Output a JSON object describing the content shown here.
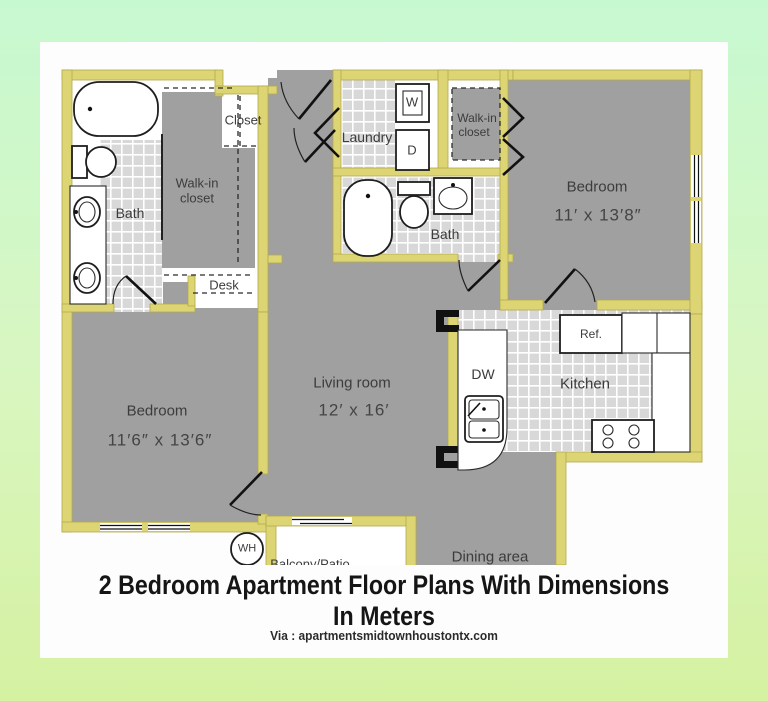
{
  "caption": {
    "title": "2 Bedroom Apartment Floor Plans With Dimensions In Meters",
    "credit": "Via : apartmentsmidtownhoustontx.com"
  },
  "plan": {
    "bedroom_left": {
      "name": "Bedroom",
      "dim": "11′6″ x 13′6″"
    },
    "bedroom_right": {
      "name": "Bedroom",
      "dim": "11′ x 13′8″"
    },
    "living_room": {
      "name": "Living room",
      "dim": "12′ x 16′"
    },
    "kitchen": {
      "name": "Kitchen"
    },
    "dining": {
      "name": "Dining area"
    },
    "bath_left": {
      "name": "Bath"
    },
    "bath_right": {
      "name": "Bath"
    },
    "laundry": {
      "name": "Laundry"
    },
    "walkin_left": {
      "line1": "Walk-in",
      "line2": "closet"
    },
    "walkin_right": {
      "line1": "Walk-in",
      "line2": "closet"
    },
    "closet": {
      "name": "Closet"
    },
    "desk": {
      "name": "Desk"
    },
    "balcony": {
      "name": "Balcony/Patio"
    },
    "washer": "W",
    "dryer": "D",
    "dishwasher": "DW",
    "refrigerator": "Ref.",
    "water_heater": "WH"
  },
  "colors": {
    "wall": "#ddd574",
    "room": "#a0a0a0",
    "tile": "#d8d8d8",
    "background_top": "#c7f9d1",
    "background_bottom": "#d5f1a1",
    "card": "#fdfdfd"
  }
}
